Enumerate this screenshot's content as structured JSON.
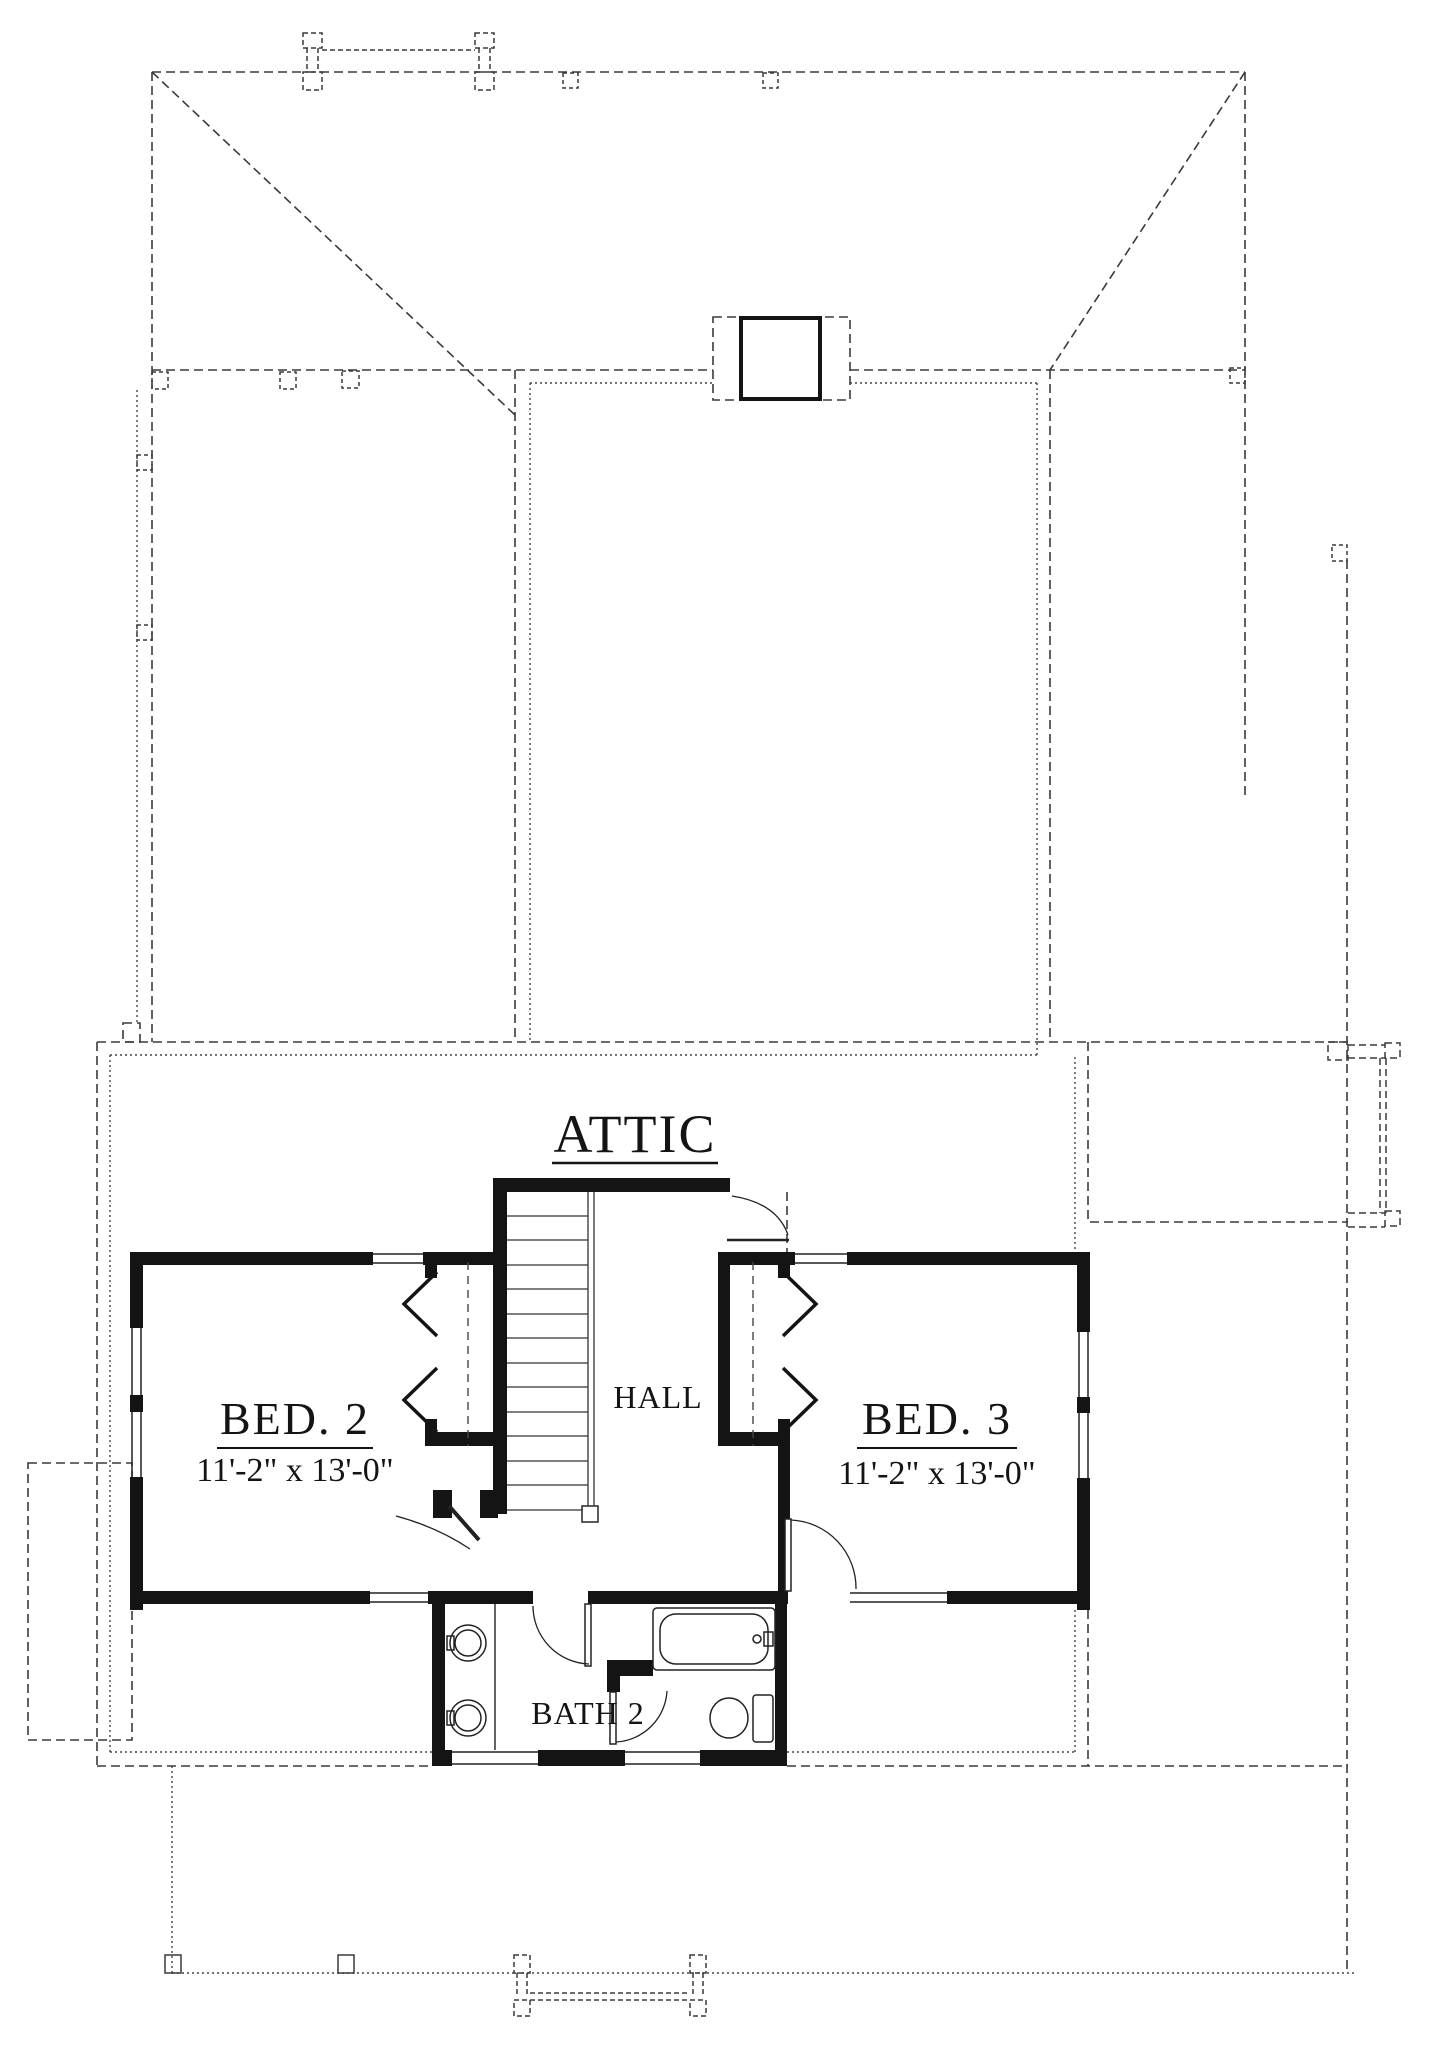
{
  "sheet": {
    "background": "#ffffff",
    "line_color": "#3a3a3a",
    "wall_color": "#141414"
  },
  "rooms": {
    "attic": {
      "label": "ATTIC"
    },
    "hall": {
      "label": "HALL"
    },
    "bed2": {
      "label": "BED. 2",
      "dimensions": "11'-2\" x 13'-0\""
    },
    "bed3": {
      "label": "BED. 3",
      "dimensions": "11'-2\" x 13'-0\""
    },
    "bath2": {
      "label": "BATH 2"
    }
  }
}
